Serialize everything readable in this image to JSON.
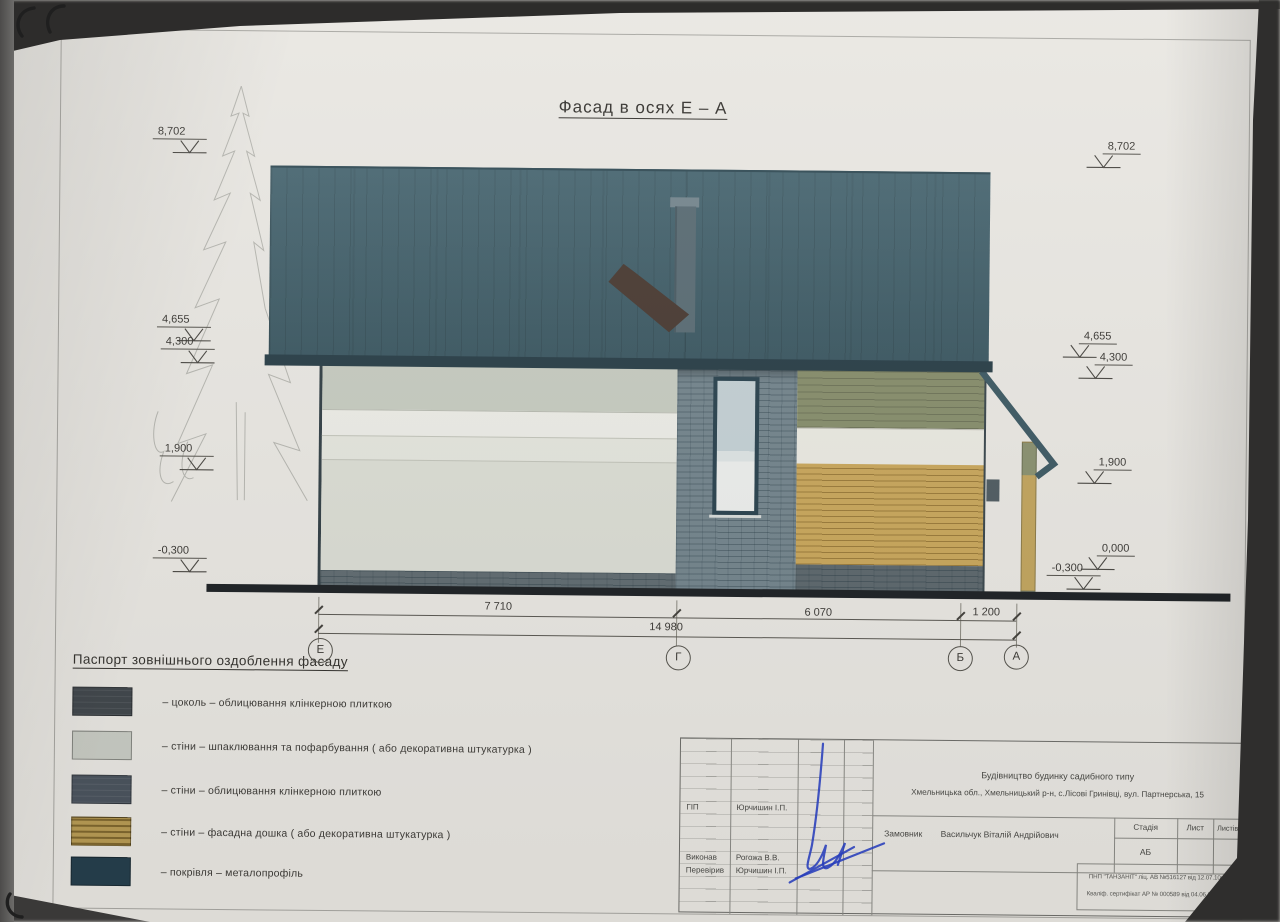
{
  "sheet": {
    "title": "Фасад в осях  Е – А"
  },
  "elevations": {
    "left": [
      "8,702",
      "4,655",
      "4,300",
      "1,900",
      "-0,300"
    ],
    "right": [
      "8,702",
      "4,655",
      "4,300",
      "1,900",
      "0,000",
      "-0,300"
    ]
  },
  "dimensions": {
    "segments": [
      "7 710",
      "6 070",
      "1 200"
    ],
    "total": "14 980",
    "axes": [
      "Е",
      "Г",
      "Б",
      "А"
    ]
  },
  "legend": {
    "title": "Паспорт зовнішнього оздоблення фасаду",
    "items": [
      {
        "color": "#41474c",
        "text": "–   цоколь   –   облицювання клінкерною плиткою"
      },
      {
        "color": "#c9ccc4",
        "text": "–   стіни   –   шпаклювання та пофарбування ( або декоративна штукатурка )"
      },
      {
        "color": "#4b545e",
        "text": "–   стіни   –   облицювання клінкерною плиткою"
      },
      {
        "color": "#b89c55",
        "text": "–   стіни   –   фасадна дошка ( або декоративна штукатурка )"
      },
      {
        "color": "#263f4d",
        "text": "–   покрівля   –   металопрофіль"
      }
    ]
  },
  "title_block": {
    "project": "Будівництво будинку садибного типу",
    "address": "Хмельницька обл.,   Хмельницький р-н,  с.Лісові Гринівці,  вул. Партнерська, 15",
    "client_label": "Замовник",
    "client_name": "Васильчук Віталій Андрійович",
    "stage_header": "Стадія",
    "sheet_header": "Лист",
    "sheets_header": "Листів",
    "stage_value": "АБ",
    "roles": [
      {
        "role": "ГІП",
        "name": "Юрчишин І.П."
      },
      {
        "role": "Виконав",
        "name": "Рогожа В.В."
      },
      {
        "role": "Перевірив",
        "name": "Юрчишин І.П."
      }
    ],
    "license_line1": "ПНП \"ТАНЗАНІТ\"  ліц. АВ №516127 від 12.07.10р.",
    "license_line2": "Кваліф. сертифікат АР № 000589 від 04.06.2012 р."
  },
  "colors": {
    "roof": "#43626d",
    "plinth_brick": "#616c71",
    "wall_paint": "#dbddd4",
    "wall_brick": "#74858d",
    "wall_board": "#c9a75c"
  }
}
